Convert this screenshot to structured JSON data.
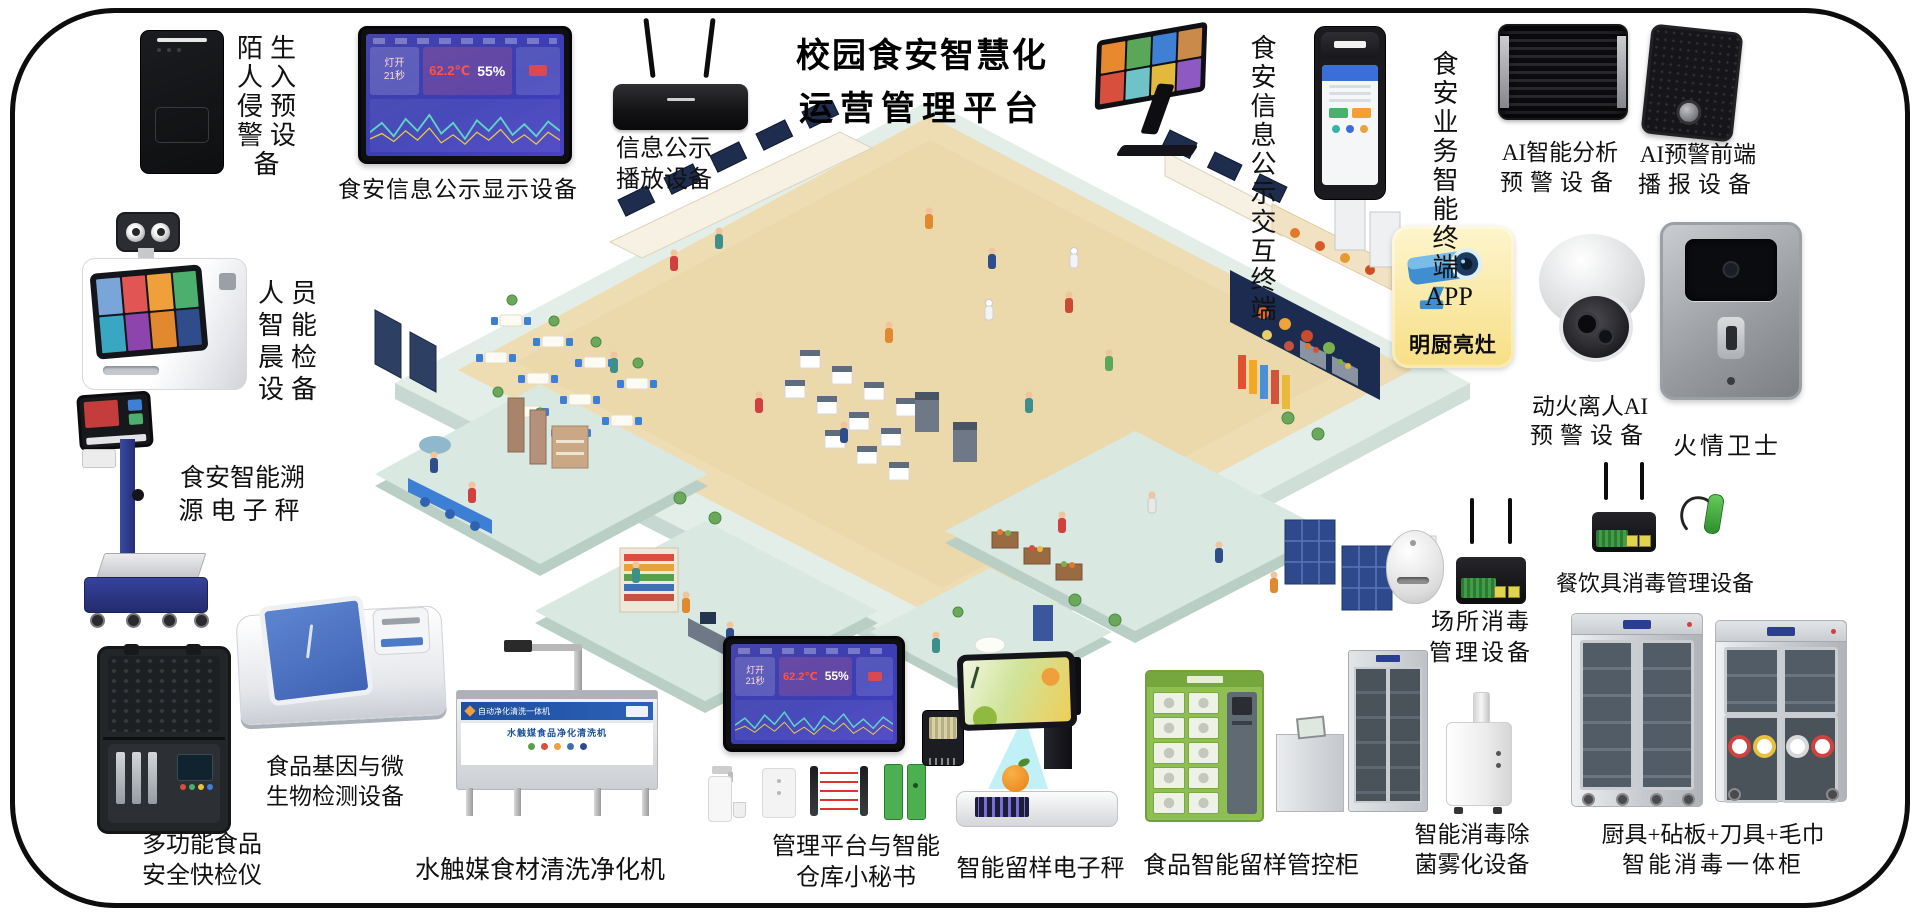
{
  "title": {
    "line1": "校园食安智慧化",
    "line2": "运营管理平台"
  },
  "screen": {
    "power_label": "灯开",
    "power_value": "21秒",
    "temp": "62.2℃",
    "humidity": "55%"
  },
  "mingchu": {
    "label": "明厨亮灶"
  },
  "washer_device": {
    "banner_top": "自动净化清洗一体机",
    "banner_main": "水触媒食品净化清洗机"
  },
  "labels": {
    "stranger": [
      "陌生",
      "人入",
      "侵预",
      "警设",
      "备"
    ],
    "display": [
      "食安信息公示显示设备"
    ],
    "broadcast": [
      "信息公示",
      "播放设备"
    ],
    "kiosk": [
      "食安",
      "信息",
      "公示",
      "交互",
      "终端"
    ],
    "pos_app": [
      "食安",
      "业务",
      "智能",
      "终端",
      "APP"
    ],
    "ai_analysis": [
      "AI智能分析",
      "预警设备"
    ],
    "ai_speaker": [
      "AI预警前端",
      "播报设备"
    ],
    "morning": [
      "人员",
      "智能",
      "晨检",
      "设备"
    ],
    "trace_scale": [
      "食安智能溯",
      "源电子秤"
    ],
    "rapid_test": [
      "多功能食品",
      "安全快检仪"
    ],
    "gene": [
      "食品基因与微",
      "生物检测设备"
    ],
    "washer": [
      "水触媒食材清洗净化机"
    ],
    "platform": [
      "管理平台与智能",
      "仓库小秘书"
    ],
    "sample_scale": [
      "智能留样电子秤"
    ],
    "sample_cabinet": [
      "食品智能留样管控柜"
    ],
    "fogger": [
      "智能消毒除",
      "菌雾化设备"
    ],
    "kitchen_cabinet": [
      "厨具+砧板+刀具+毛巾",
      "智能消毒一体柜"
    ],
    "place_disinfect": [
      "场所消毒",
      "管理设备"
    ],
    "tableware": [
      "餐饮具消毒管理设备"
    ],
    "fire_ai": [
      "动火离人AI",
      "预警设备"
    ],
    "fire_guard": [
      "火情卫士"
    ]
  }
}
